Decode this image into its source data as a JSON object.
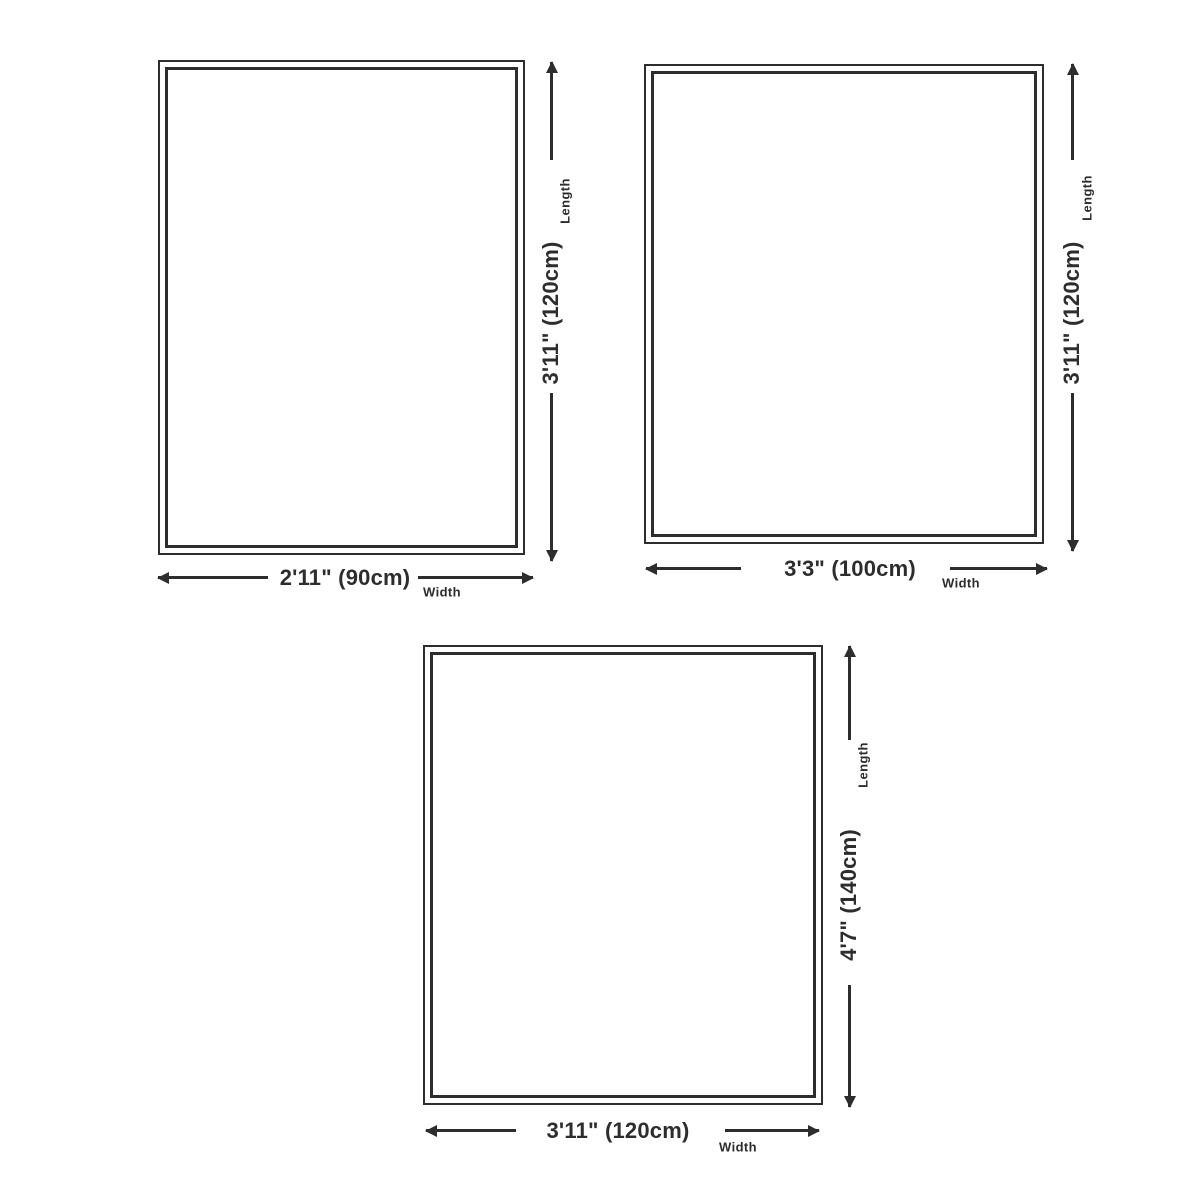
{
  "colors": {
    "line": "#2d2d2d",
    "background": "#ffffff"
  },
  "diagrams": [
    {
      "name": "size-90x120",
      "width_label": "2'11\" (90cm)",
      "length_label": "3'11\" (120cm)",
      "width_caption": "Width",
      "length_caption": "Length"
    },
    {
      "name": "size-100x120",
      "width_label": "3'3\" (100cm)",
      "length_label": "3'11\" (120cm)",
      "width_caption": "Width",
      "length_caption": "Length"
    },
    {
      "name": "size-120x140",
      "width_label": "3'11\" (120cm)",
      "length_label": "4'7\" (140cm)",
      "width_caption": "Width",
      "length_caption": "Length"
    }
  ]
}
